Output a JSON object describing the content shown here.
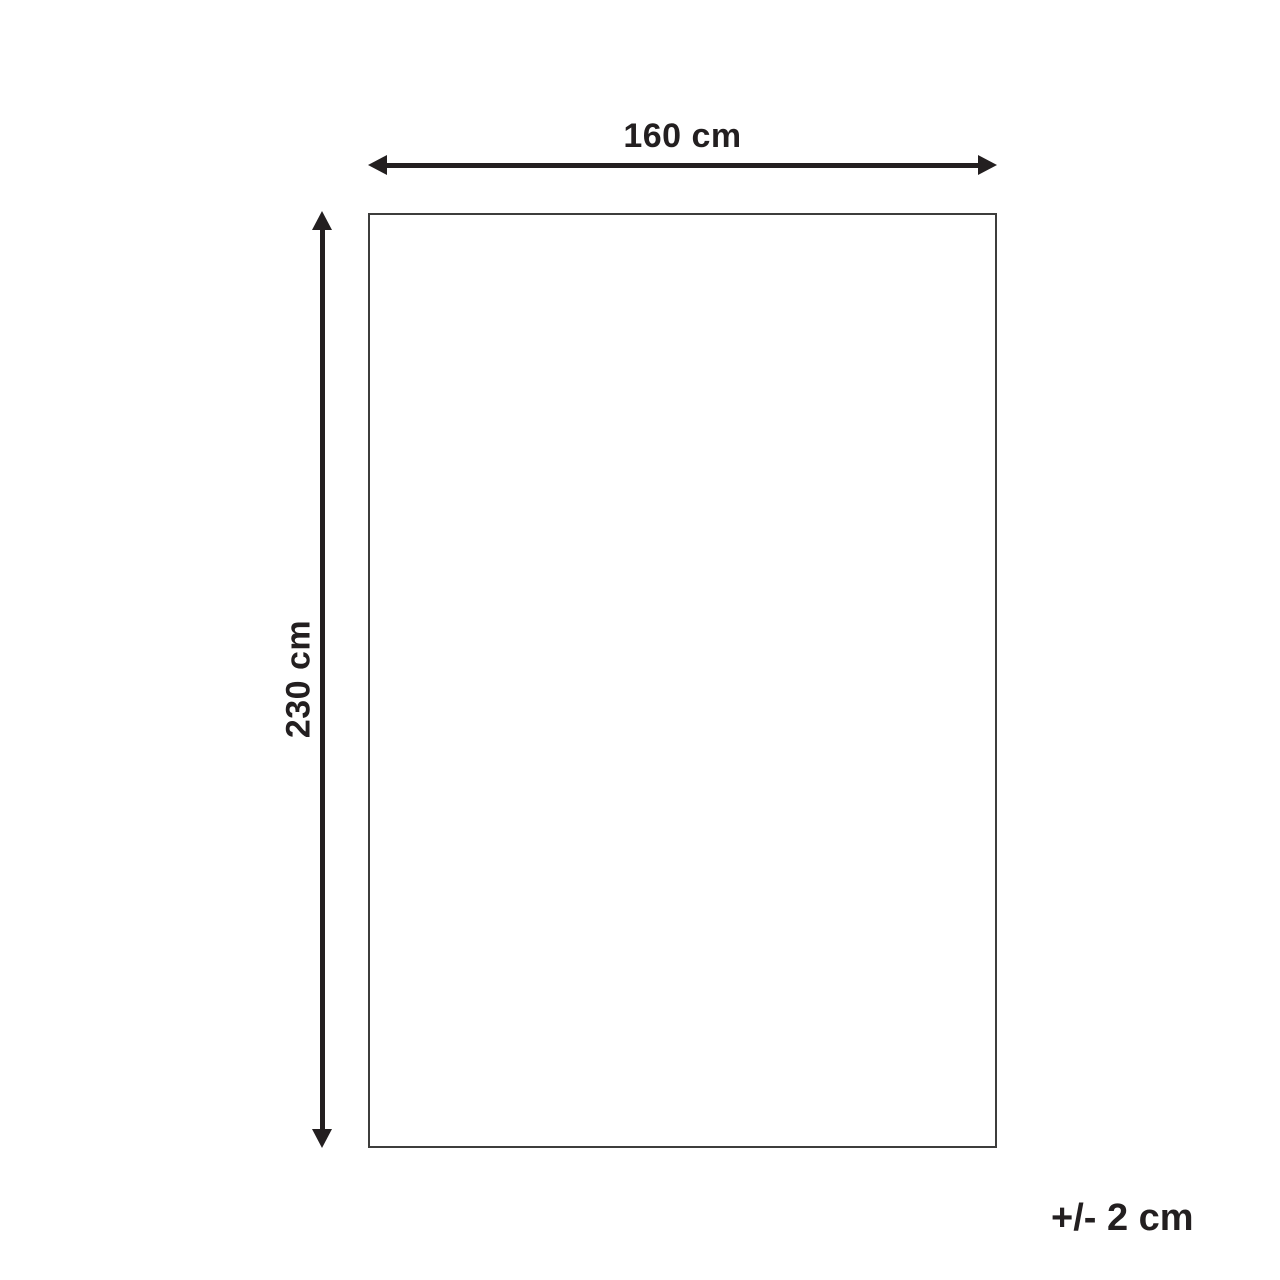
{
  "diagram": {
    "type": "product-dimensions",
    "width_label": "160 cm",
    "height_label": "230 cm",
    "tolerance_label": "+/- 2 cm",
    "colors": {
      "ink": "#231f20",
      "outline": "#3d3d3c",
      "background": "#ffffff"
    }
  }
}
